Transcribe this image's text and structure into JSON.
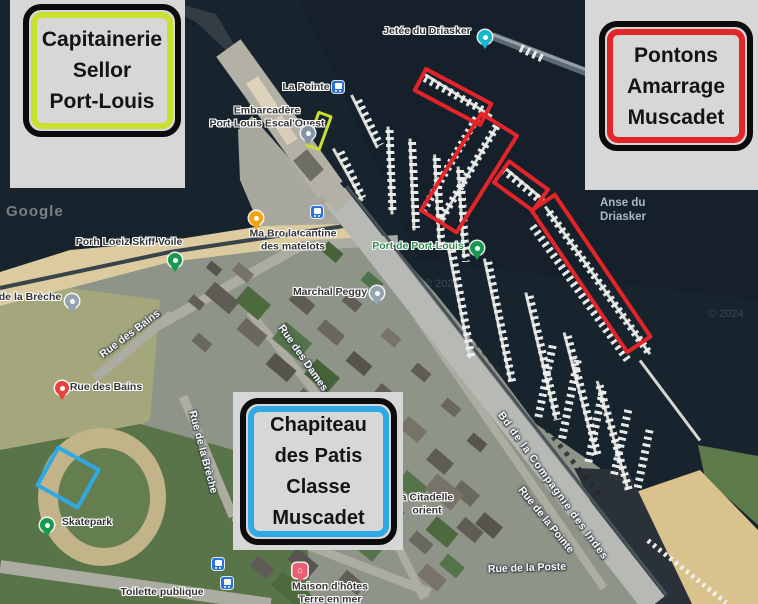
{
  "callouts": {
    "capitainerie": {
      "lines": [
        "Capitainerie",
        "Sellor",
        "Port-Louis"
      ],
      "border_color": "#c9e02f"
    },
    "pontons": {
      "lines": [
        "Pontons",
        "Amarrage",
        "Muscadet"
      ],
      "border_color": "#e32428"
    },
    "chapiteau": {
      "lines": [
        "Chapiteau",
        "des Patis",
        "Classe",
        "Muscadet"
      ],
      "border_color": "#2fa9e4"
    }
  },
  "colors": {
    "panel_gray": "#d7d7d7",
    "box_black": "#0c0c0c",
    "annotation_red": "#e32428",
    "annotation_blue": "#2fa9e4",
    "annotation_chartreuse": "#c9e02f",
    "water": "#16222c",
    "poi_text": "#343434",
    "street_text": "#fdfdfd",
    "water_text": "#a9bac3",
    "marina_text": "#2e8b4f"
  },
  "map": {
    "poi_labels": [
      {
        "name": "jetee-du-driasker-label",
        "lines": [
          "Jetée du Driasker"
        ],
        "x": 427,
        "y": 31
      },
      {
        "name": "la-pointe-label",
        "lines": [
          "La Pointe"
        ],
        "x": 306,
        "y": 87
      },
      {
        "name": "embarcadere-label",
        "lines": [
          "Embarcadère",
          "Port-Louis Escal'Ouest"
        ],
        "x": 267,
        "y": 117
      },
      {
        "name": "porh-loeiz-skiff-voile-label",
        "lines": [
          "Porh Loeiz Skiff Voile"
        ],
        "x": 129,
        "y": 242
      },
      {
        "name": "de-la-breche-label",
        "lines": [
          "de la Brèche"
        ],
        "x": 30,
        "y": 297
      },
      {
        "name": "rue-des-bains-poi-label",
        "lines": [
          "Rue des Bains"
        ],
        "x": 106,
        "y": 387
      },
      {
        "name": "ma-bro-cantine-label",
        "lines": [
          "Ma Bro la cantine",
          "des matelots"
        ],
        "x": 293,
        "y": 240
      },
      {
        "name": "marchal-peggy-label",
        "lines": [
          "Marchal Peggy"
        ],
        "x": 330,
        "y": 292
      },
      {
        "name": "port-de-port-louis-label",
        "lines": [
          "Port de Port-Louis"
        ],
        "x": 418,
        "y": 246,
        "color": "#2e8b4f"
      },
      {
        "name": "skatepark-label",
        "lines": [
          "Skatepark"
        ],
        "x": 87,
        "y": 522
      },
      {
        "name": "toilette-publique-label",
        "lines": [
          "Toilette publique"
        ],
        "x": 162,
        "y": 592
      },
      {
        "name": "maison-dhotes-label",
        "lines": [
          "Maison d'hôtes",
          "Terre en mer"
        ],
        "x": 330,
        "y": 593
      },
      {
        "name": "citadelle-label",
        "lines": [
          "a Citadelle",
          "orient"
        ],
        "x": 427,
        "y": 504
      }
    ],
    "street_labels": [
      {
        "name": "rue-des-bains-street",
        "text": "Rue des Bains",
        "x": 130,
        "y": 334,
        "rotate": -37
      },
      {
        "name": "rue-de-la-breche-street",
        "text": "Rue de la Brèche",
        "x": 203,
        "y": 452,
        "rotate": 75
      },
      {
        "name": "rue-des-dames-street",
        "text": "Rue des Dames",
        "x": 303,
        "y": 358,
        "rotate": 55
      },
      {
        "name": "bd-compagnie-des-indes-street",
        "text": "Bd de la Compagnie des Indes",
        "x": 553,
        "y": 486,
        "rotate": 54,
        "spacing": 1
      },
      {
        "name": "rue-de-la-pointe-street",
        "text": "Rue de la Pointe",
        "x": 546,
        "y": 520,
        "rotate": 51
      },
      {
        "name": "rue-de-la-poste-street",
        "text": "Rue de la Poste",
        "x": 527,
        "y": 568,
        "rotate": -2
      }
    ],
    "water_labels": [
      {
        "name": "anse-du-driasker-label",
        "lines": [
          "Anse du",
          "Driasker"
        ],
        "x": 600,
        "y": 197
      }
    ],
    "watermarks": [
      {
        "name": "google-watermark",
        "text": "Google",
        "x": 6,
        "y": 203,
        "style": "google"
      },
      {
        "name": "copyright-watermark",
        "text": "© 2024",
        "x": 424,
        "y": 278,
        "style": "copy"
      },
      {
        "name": "copyright-watermark",
        "text": "© 2024",
        "x": 708,
        "y": 308,
        "style": "copy"
      }
    ],
    "pins": [
      {
        "name": "photo-pin",
        "type": "circle",
        "color": "#16b8cc",
        "x": 485,
        "y": 44
      },
      {
        "name": "transit-icon",
        "type": "transit",
        "x": 338,
        "y": 87
      },
      {
        "name": "ferry-pin",
        "type": "circle",
        "color": "#8496a6",
        "x": 308,
        "y": 140
      },
      {
        "name": "sailing-pin",
        "type": "circle",
        "color": "#17994f",
        "x": 175,
        "y": 267
      },
      {
        "name": "breche-pin",
        "type": "circle",
        "color": "#95a4b2",
        "x": 72,
        "y": 308
      },
      {
        "name": "restaurant-pin",
        "type": "circle",
        "color": "#f2a50f",
        "x": 256,
        "y": 225
      },
      {
        "name": "marina-pin",
        "type": "circle",
        "color": "#17994f",
        "x": 477,
        "y": 255
      },
      {
        "name": "marchal-peggy-pin",
        "type": "circle",
        "color": "#95a4b2",
        "x": 377,
        "y": 300
      },
      {
        "name": "rue-des-bains-pin",
        "type": "circle",
        "color": "#e6443a",
        "x": 62,
        "y": 395
      },
      {
        "name": "skatepark-pin",
        "type": "circle",
        "color": "#17994f",
        "x": 47,
        "y": 532
      },
      {
        "name": "lodging-pin",
        "type": "square",
        "color": "#e85f74",
        "x": 300,
        "y": 578,
        "glyph": "⌂"
      },
      {
        "name": "shop-pin",
        "type": "chip",
        "color": "#d43f35",
        "x": 267,
        "y": 543
      },
      {
        "name": "transit-icon",
        "type": "transit",
        "x": 218,
        "y": 564
      },
      {
        "name": "transit-icon",
        "type": "transit",
        "x": 227,
        "y": 583
      },
      {
        "name": "transit-icon",
        "type": "transit",
        "x": 317,
        "y": 212
      }
    ]
  },
  "annotations": [
    {
      "name": "red-rect-pontons-1",
      "color": "#e32428",
      "x": 453,
      "y": 97,
      "w": 78,
      "h": 28,
      "rotate": 28,
      "border": 4
    },
    {
      "name": "red-rect-pontons-2",
      "color": "#e32428",
      "x": 469,
      "y": 173,
      "w": 46,
      "h": 118,
      "rotate": 32,
      "border": 4
    },
    {
      "name": "red-rect-pontons-3",
      "color": "#e32428",
      "x": 521,
      "y": 186,
      "w": 52,
      "h": 30,
      "rotate": 36,
      "border": 4
    },
    {
      "name": "red-rect-pontons-4",
      "color": "#e32428",
      "x": 591,
      "y": 273,
      "w": 32,
      "h": 175,
      "rotate": -34,
      "border": 4
    },
    {
      "name": "chartreuse-rect-embarcadere",
      "color": "#c9e02f",
      "x": 319,
      "y": 131,
      "w": 16,
      "h": 38,
      "rotate": 20,
      "border": 3
    },
    {
      "name": "blue-rect-chapiteau",
      "color": "#2fa9e4",
      "x": 68,
      "y": 477,
      "w": 50,
      "h": 47,
      "rotate": 29,
      "border": 4
    }
  ]
}
